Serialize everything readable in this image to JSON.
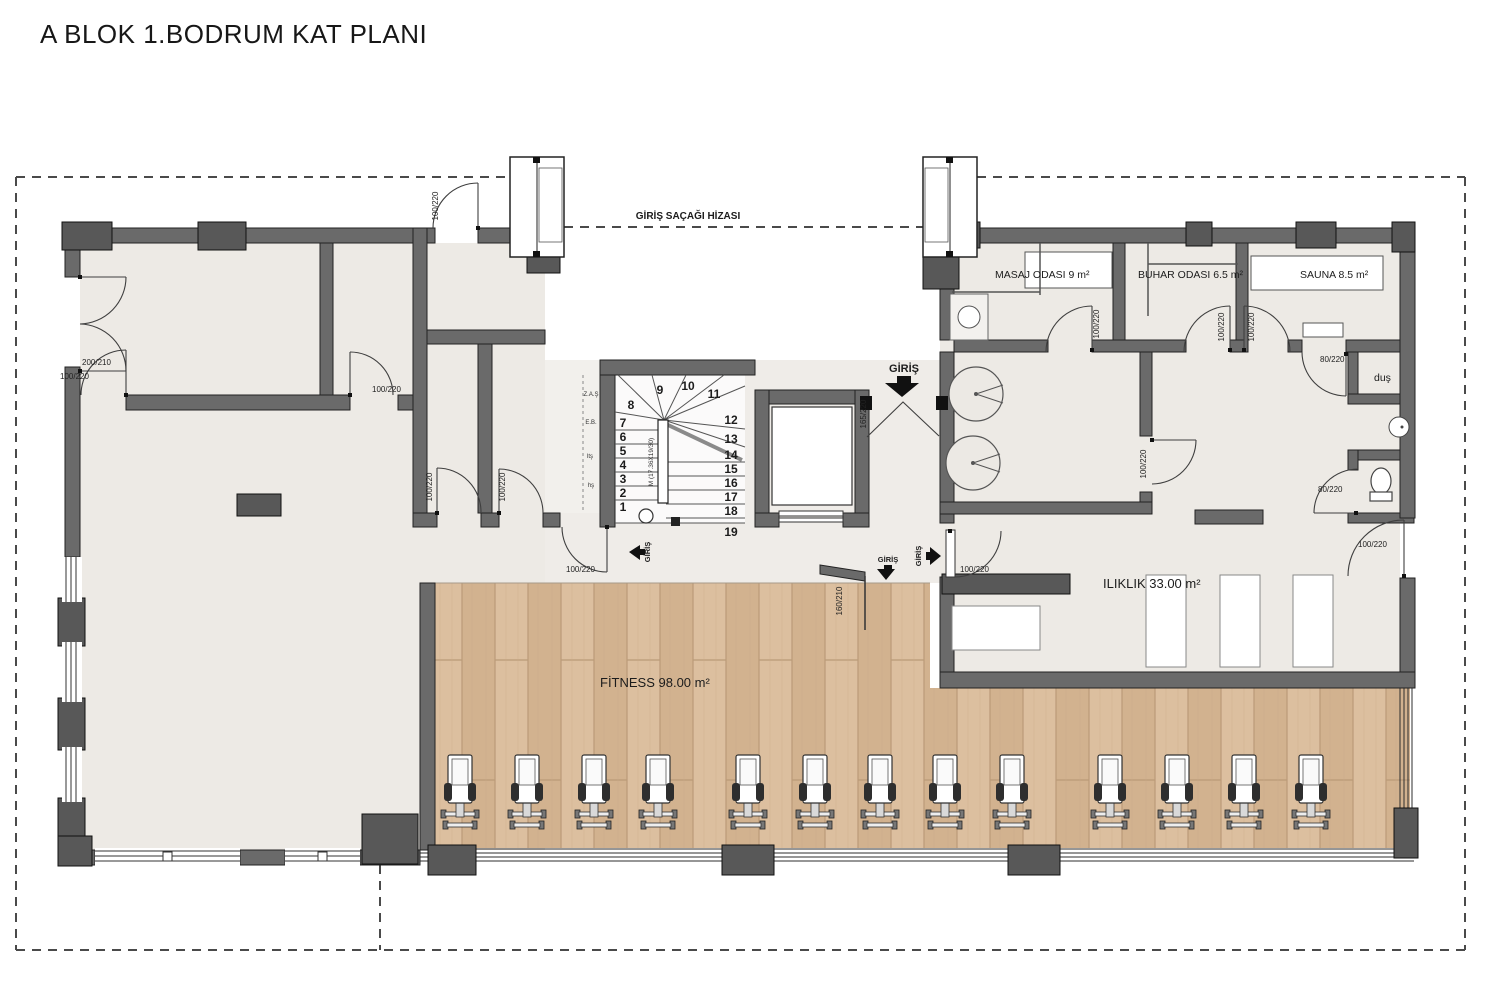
{
  "title": "A BLOK 1.BODRUM KAT PLANI",
  "canopy_label": "GİRİŞ SAÇAĞI HİZASI",
  "entrance_label": "GİRİŞ",
  "rooms": {
    "masaj": "MASAJ ODASI  9 m²",
    "buhar": "BUHAR ODASI  6.5 m²",
    "sauna": "SAUNA  8.5 m²",
    "dus": "duş",
    "iliklik": "ILIKLIK  33.00 m²",
    "fitness": "FİTNESS  98.00 m²"
  },
  "stairs": {
    "numbers": [
      "1",
      "2",
      "3",
      "4",
      "5",
      "6",
      "7",
      "8",
      "9",
      "10",
      "11",
      "12",
      "13",
      "14",
      "15",
      "16",
      "17",
      "18",
      "19"
    ],
    "spec": "M (17.36X19/30)",
    "shaft_notes": [
      "Z.A.Ş",
      "E.B.",
      "ltş",
      "hş"
    ]
  },
  "doors": {
    "d_top": "100/220",
    "d_left": "200/210",
    "d_room1": "100/220",
    "d_room2": "100/220",
    "d_small_a": "100/220",
    "d_small_b": "100/220",
    "d_corridor": "100/220",
    "d_entry": "165/220",
    "d_masaj": "100/220",
    "d_buhar": "100/220",
    "d_sauna": "100/220",
    "d_dus": "80/220",
    "d_wc": "80/220",
    "d_mid": "100/220",
    "d_iliklik_w": "100/220",
    "d_iliklik_e": "100/220",
    "d_fitness": "160/210"
  },
  "colors": {
    "wall": "#6a6a6a",
    "pier": "#585858",
    "floor": "#edeae5",
    "wood": "#d6b795"
  }
}
